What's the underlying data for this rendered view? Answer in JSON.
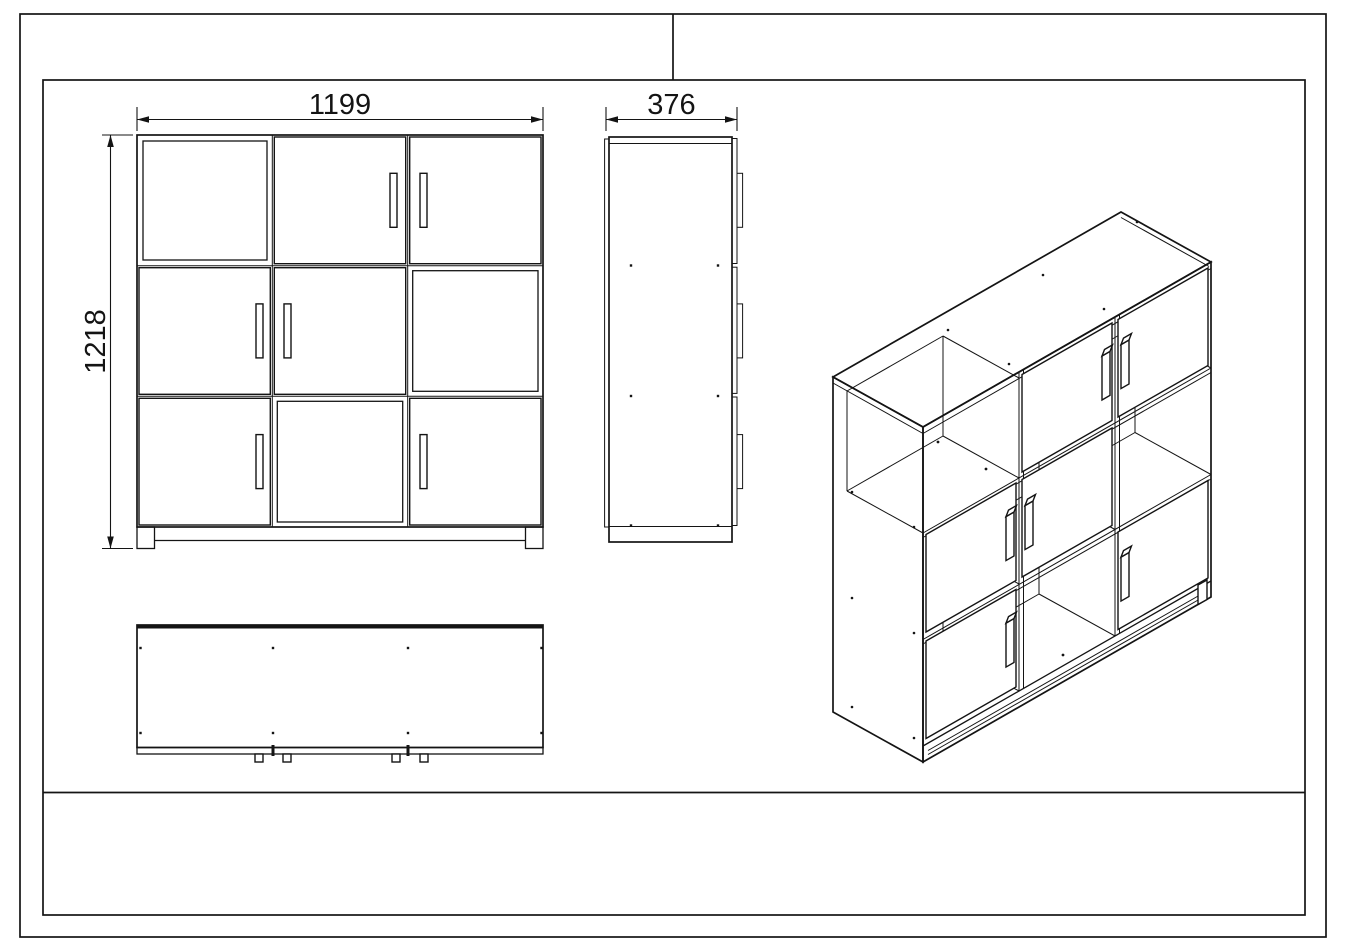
{
  "colors": {
    "line": "#141414",
    "background": "#ffffff"
  },
  "views": {
    "front": {
      "width_label": "1199",
      "height_label": "1218"
    },
    "side": {
      "depth_label": "376"
    }
  }
}
